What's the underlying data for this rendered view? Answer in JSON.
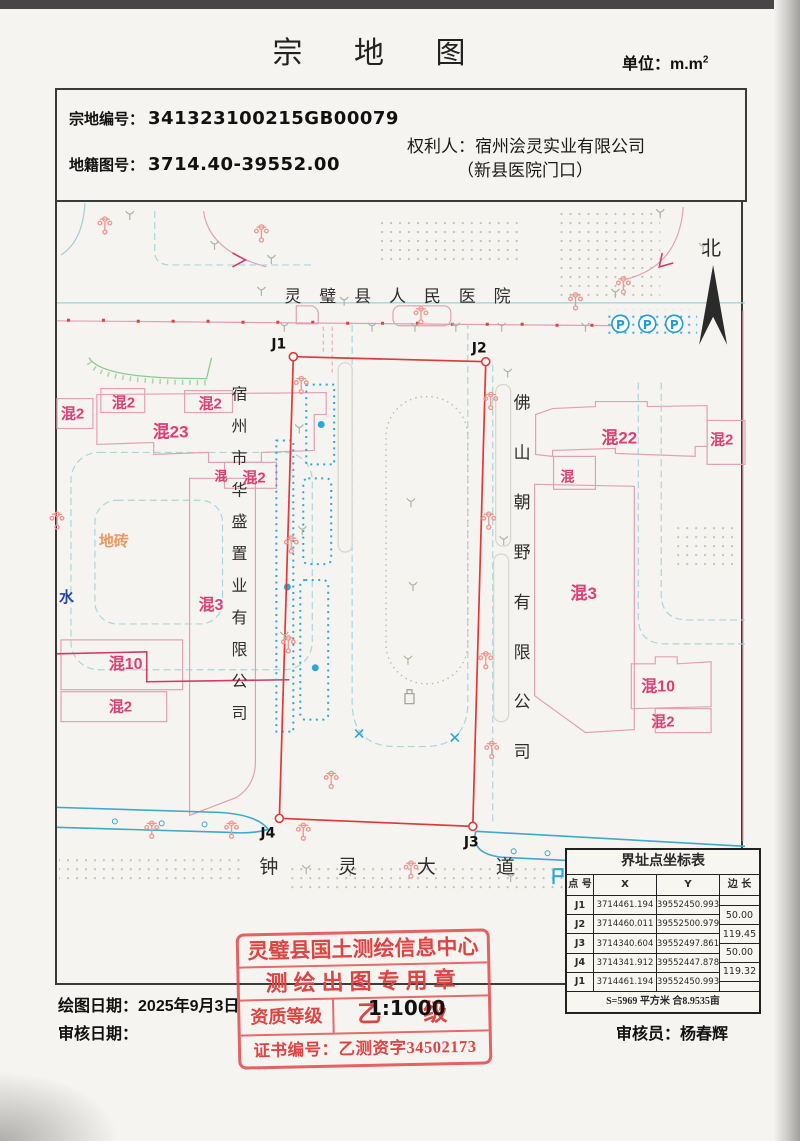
{
  "title": "宗 地 图",
  "unit": {
    "label": "单位：m.m",
    "sup": "2"
  },
  "header": {
    "parcel_no_label": "宗地编号：",
    "parcel_no": "341323100215GB00079",
    "sheet_no_label": "地籍图号：",
    "sheet_no": "3714.40-39552.00",
    "owner_label": "权利人：",
    "owner": "宿州浍灵实业有限公司",
    "owner_note": "（新县医院门口）"
  },
  "map": {
    "labels": [
      {
        "t": "北",
        "x": 646,
        "y": 52,
        "c": "k",
        "s": 20
      },
      {
        "t": "灵璧县人民医院",
        "x": 228,
        "y": 99,
        "c": "k",
        "s": 17,
        "ls": 18
      },
      {
        "t": "钟灵大道",
        "x": 203,
        "y": 672,
        "c": "k",
        "s": 19,
        "ls": 60
      },
      {
        "t": "宿州市华盛置业有限公司",
        "x": 175,
        "y": 197,
        "c": "k",
        "s": 16,
        "vstep": 32
      },
      {
        "t": "佛山朝野有限公司",
        "x": 458,
        "y": 206,
        "c": "k",
        "s": 17,
        "vstep": 50
      },
      {
        "t": "混2",
        "x": 4,
        "y": 216,
        "c": "m",
        "s": 15
      },
      {
        "t": "混2",
        "x": 55,
        "y": 205,
        "c": "m",
        "s": 15
      },
      {
        "t": "混2",
        "x": 142,
        "y": 206,
        "c": "m",
        "s": 15
      },
      {
        "t": "混23",
        "x": 96,
        "y": 235,
        "c": "m",
        "s": 17
      },
      {
        "t": "混",
        "x": 158,
        "y": 278,
        "c": "m",
        "s": 13
      },
      {
        "t": "混2",
        "x": 186,
        "y": 280,
        "c": "m",
        "s": 15
      },
      {
        "t": "混3",
        "x": 142,
        "y": 408,
        "c": "m",
        "s": 16
      },
      {
        "t": "混10",
        "x": 52,
        "y": 467,
        "c": "m",
        "s": 16
      },
      {
        "t": "混2",
        "x": 52,
        "y": 510,
        "c": "m",
        "s": 15
      },
      {
        "t": "混22",
        "x": 546,
        "y": 241,
        "c": "m",
        "s": 17
      },
      {
        "t": "混2",
        "x": 655,
        "y": 242,
        "c": "m",
        "s": 15
      },
      {
        "t": "混",
        "x": 505,
        "y": 279,
        "c": "m",
        "s": 14
      },
      {
        "t": "混3",
        "x": 515,
        "y": 397,
        "c": "m",
        "s": 17
      },
      {
        "t": "混10",
        "x": 586,
        "y": 490,
        "c": "m",
        "s": 16
      },
      {
        "t": "混2",
        "x": 596,
        "y": 525,
        "c": "m",
        "s": 15
      },
      {
        "t": "地砖",
        "x": 42,
        "y": 344,
        "c": "o",
        "s": 15
      },
      {
        "t": "水",
        "x": 2,
        "y": 400,
        "c": "b",
        "s": 15
      }
    ],
    "points": [
      {
        "n": "J1",
        "x": 237,
        "y": 154,
        "tx": 215,
        "ty": 146
      },
      {
        "n": "J2",
        "x": 430,
        "y": 159,
        "tx": 416,
        "ty": 150
      },
      {
        "n": "J3",
        "x": 417,
        "y": 625,
        "tx": 408,
        "ty": 645
      },
      {
        "n": "J4",
        "x": 223,
        "y": 617,
        "tx": 204,
        "ty": 636
      }
    ],
    "parking": [
      "P",
      "P",
      "P"
    ]
  },
  "coords_table": {
    "title": "界址点坐标表",
    "headers": [
      "点 号",
      "X",
      "Y",
      "边 长"
    ],
    "rows": [
      [
        "J1",
        "3714461.194",
        "39552450.993"
      ],
      [
        "J2",
        "3714460.011",
        "39552500.979"
      ],
      [
        "J3",
        "3714340.604",
        "39552497.861"
      ],
      [
        "J4",
        "3714341.912",
        "39552447.878"
      ],
      [
        "J1",
        "3714461.194",
        "39552450.993"
      ]
    ],
    "side_lengths": [
      "50.00",
      "119.45",
      "50.00",
      "119.32"
    ],
    "area_note": "S=5969 平方米 合8.9535亩"
  },
  "stamp": {
    "line1": "灵璧县国土测绘信息中心",
    "line2": "测绘出图专用章",
    "grade_label": "资质等级",
    "grade": "乙 级",
    "cert": "证书编号：乙测资字34502173"
  },
  "scale": "1:1000",
  "footer": {
    "draw_date_label": "绘图日期：",
    "draw_date": "2025年9月3日",
    "review_date_label": "审核日期：",
    "review_date": "",
    "drafter_label": "绘图员：",
    "drafter": "朱向宇",
    "reviewer_label": "审核员：",
    "reviewer": "杨春辉"
  },
  "colors": {
    "boundary_red": "#e03838",
    "building_pink": "#e2a0b5",
    "label_magenta": "#dd3f74",
    "road_cyan": "#3fa9c9",
    "bed_blue": "#2da7d8",
    "stamp_red": "#e04848"
  }
}
